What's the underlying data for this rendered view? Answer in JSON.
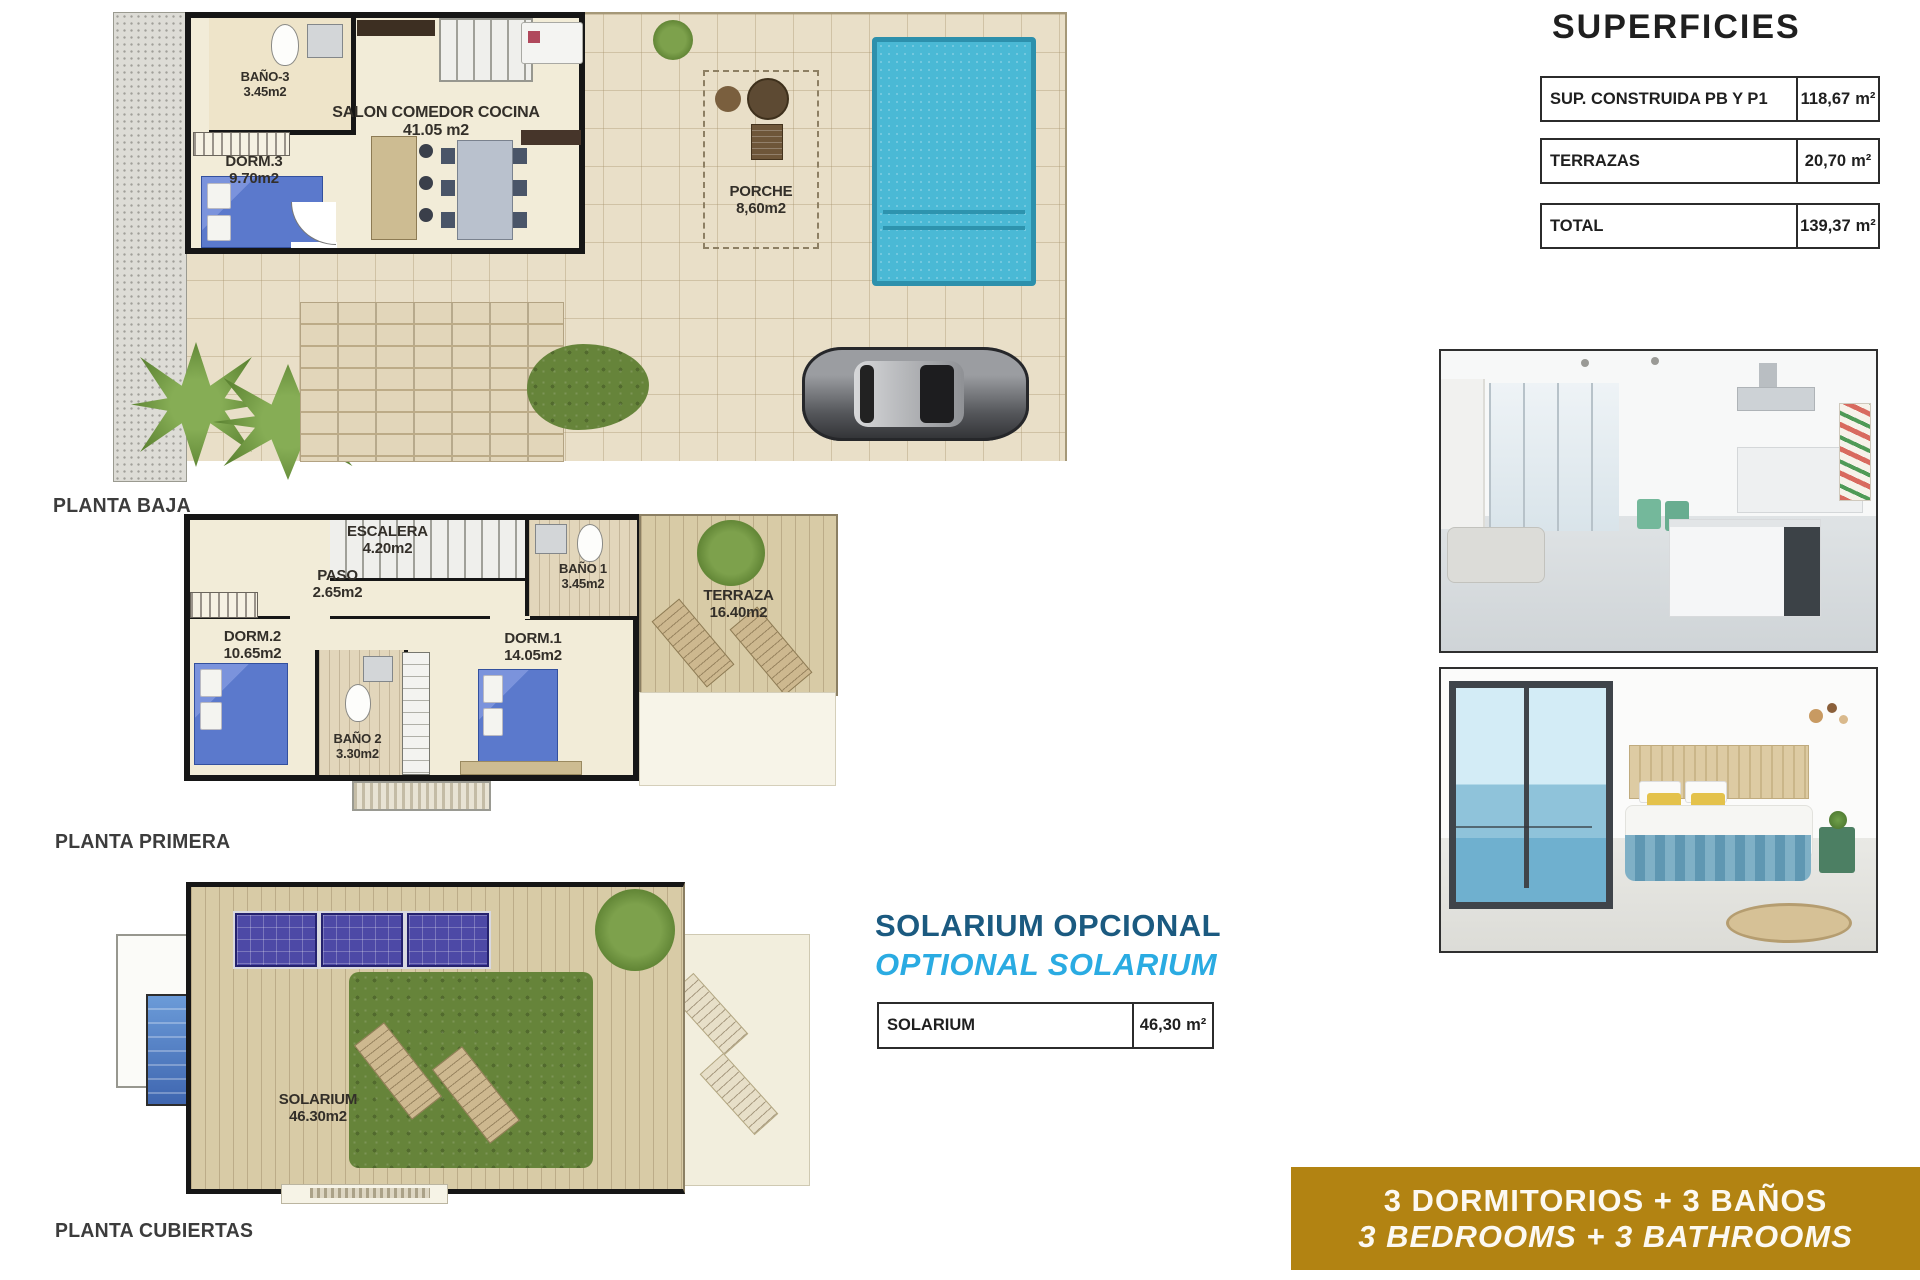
{
  "superficies": {
    "title": "SUPERFICIES",
    "rows": [
      {
        "label": "SUP. CONSTRUIDA PB Y P1",
        "value": "118,67",
        "unit": "m²"
      },
      {
        "label": "TERRAZAS",
        "value": "20,70",
        "unit": "m²"
      },
      {
        "label": "TOTAL",
        "value": "139,37",
        "unit": "m²"
      }
    ]
  },
  "plans": {
    "baja": {
      "caption": "PLANTA BAJA",
      "rooms": {
        "bano3": {
          "name": "BAÑO-3",
          "area": "3.45m2"
        },
        "dorm3": {
          "name": "DORM.3",
          "area": "9.70m2"
        },
        "salon": {
          "name": "SALON COMEDOR COCINA",
          "area": "41.05 m2"
        },
        "porche": {
          "name": "PORCHE",
          "area": "8,60m2"
        }
      }
    },
    "primera": {
      "caption": "PLANTA PRIMERA",
      "rooms": {
        "escalera": {
          "name": "ESCALERA",
          "area": "4.20m2"
        },
        "paso": {
          "name": "PASO",
          "area": "2.65m2"
        },
        "bano1": {
          "name": "BAÑO 1",
          "area": "3.45m2"
        },
        "dorm2": {
          "name": "DORM.2",
          "area": "10.65m2"
        },
        "bano2": {
          "name": "BAÑO 2",
          "area": "3.30m2"
        },
        "dorm1": {
          "name": "DORM.1",
          "area": "14.05m2"
        },
        "terraza": {
          "name": "TERRAZA",
          "area": "16.40m2"
        }
      }
    },
    "cubiertas": {
      "caption": "PLANTA CUBIERTAS",
      "rooms": {
        "solarium": {
          "name": "SOLARIUM",
          "area": "46.30m2"
        }
      }
    }
  },
  "solarium_promo": {
    "heading_es": "SOLARIUM OPCIONAL",
    "heading_en": "OPTIONAL SOLARIUM",
    "table": {
      "label": "SOLARIUM",
      "value": "46,30",
      "unit": "m²"
    }
  },
  "banner": {
    "line_es": "3 DORMITORIOS + 3 BAÑOS",
    "line_en": "3 BEDROOMS + 3 BATHROOMS"
  },
  "colors": {
    "promo_dark_blue": "#1b5a80",
    "promo_light_blue": "#2aabe2",
    "banner_gold": "#b28312",
    "pool_blue": "#4ab9d5",
    "plan_cream": "#f2ecd8",
    "grass_green": "#66843a",
    "deck_tan": "#d8cba6",
    "bed_blue": "#5b79cc"
  }
}
